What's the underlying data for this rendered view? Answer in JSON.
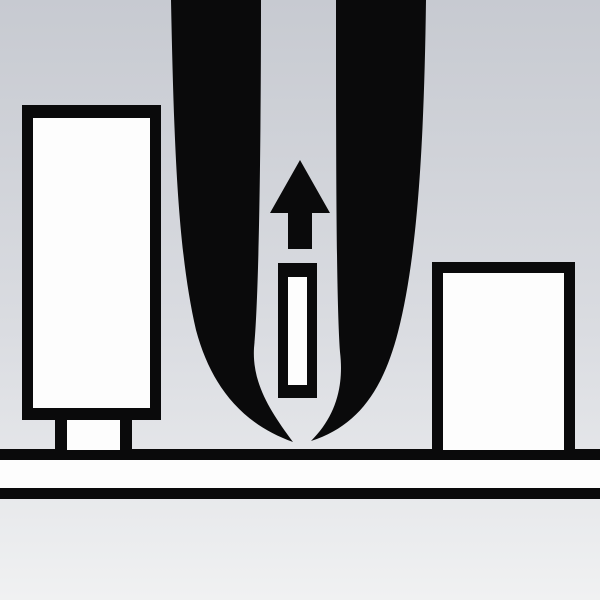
{
  "colors": {
    "ink": "#0a0a0b",
    "paper": "#fdfdfd",
    "bg_top": "#c7cad1",
    "bg_bottom": "#f0f1f2"
  },
  "scene": {
    "title": "Illustration of tweezers lifting a small component upward from a work surface",
    "labels": {
      "tweezers": "tweezers",
      "left_prong": "tweezers-left-prong",
      "right_prong": "tweezers-right-prong",
      "arrow": "upward-direction-arrow",
      "component": "small-component-being-lifted",
      "left_container": "left-container",
      "left_container_foot": "left-container-foot",
      "right_container": "right-container",
      "surface": "work-surface-edge"
    }
  }
}
